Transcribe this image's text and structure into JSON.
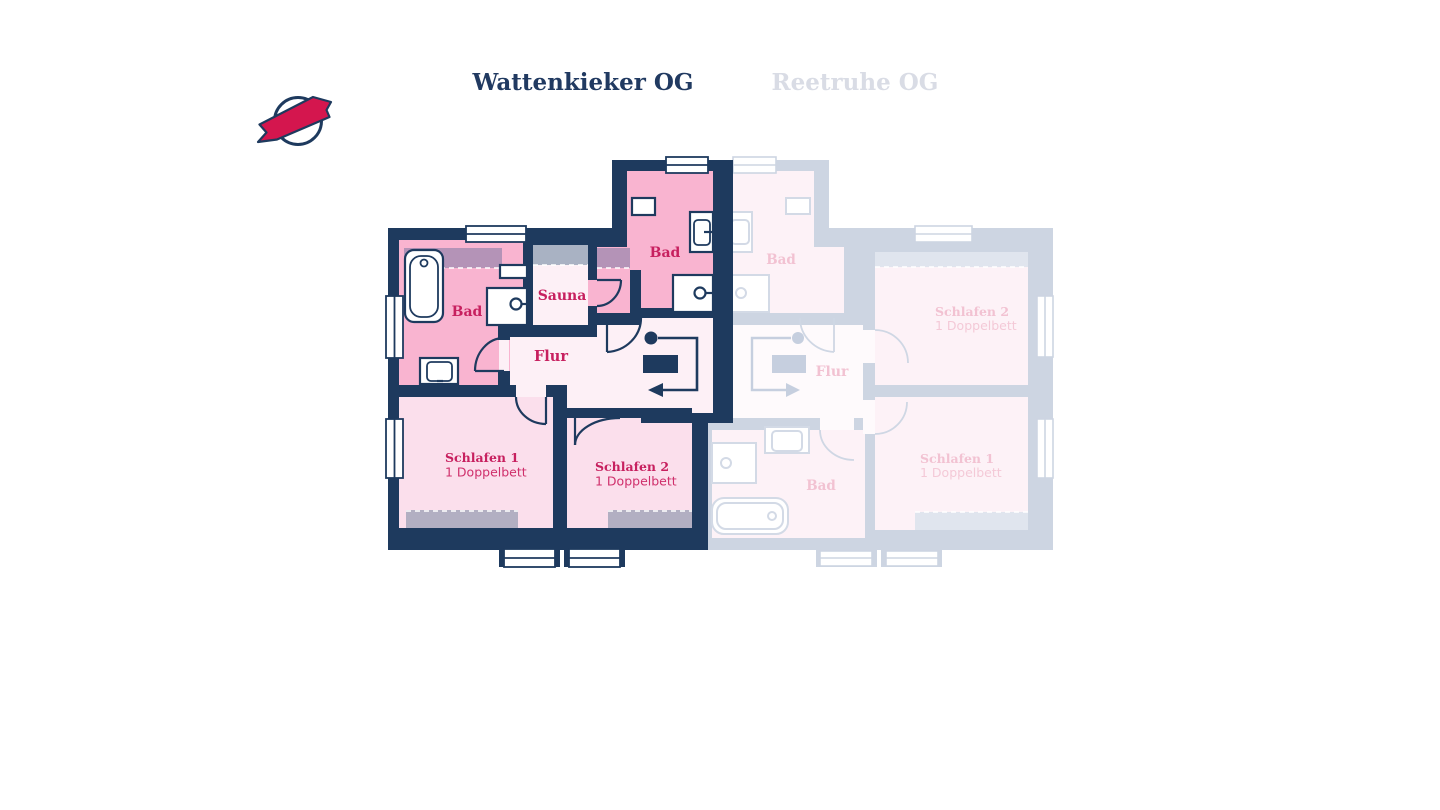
{
  "header": {
    "logo": {
      "name": "brand-logo",
      "ring_color": "#1e3a5e",
      "ribbon_color": "#d4164e"
    },
    "tabs": [
      {
        "label": "Wattenkieker OG",
        "active": true,
        "color": "#213a61"
      },
      {
        "label": "Reetruhe OG",
        "active": false,
        "color": "#d9dce5"
      }
    ]
  },
  "plans": {
    "wattenkieker": {
      "name": "Wattenkieker OG",
      "state": "active",
      "rooms": {
        "bad_top": {
          "label": "Bad"
        },
        "bad_left": {
          "label": "Bad"
        },
        "sauna": {
          "label": "Sauna"
        },
        "flur": {
          "label": "Flur"
        },
        "schlafen1": {
          "label": "Schlafen 1",
          "detail": "1 Doppelbett"
        },
        "schlafen2": {
          "label": "Schlafen 2",
          "detail": "1 Doppelbett"
        }
      }
    },
    "reetruhe": {
      "name": "Reetruhe OG",
      "state": "inactive",
      "rooms": {
        "bad_top": {
          "label": "Bad"
        },
        "flur": {
          "label": "Flur"
        },
        "bad_bottom": {
          "label": "Bad"
        },
        "schlafen2": {
          "label": "Schlafen 2",
          "detail": "1 Doppelbett"
        },
        "schlafen1": {
          "label": "Schlafen 1",
          "detail": "1 Doppelbett"
        }
      }
    }
  },
  "colors": {
    "wall_navy": "#1e3a5e",
    "room_pink_strong": "#f9b4d0",
    "room_pink_light": "#fbdfec",
    "room_pink_pale": "#fdf0f6",
    "label_crimson": "#c7205f",
    "detail_pink": "#cf2f6b",
    "hatch_on_pink": "#b493b7",
    "hatch_on_pale": "#a9b2c3",
    "hatch_on_light": "#b2afc2",
    "faded_wall": "#cdd5e2",
    "faded_room": "#fdf2f7",
    "faded_pale": "#fefafc",
    "faded_label": "#f2c2d2",
    "faded_stroke": "#d3dae6",
    "faded_hatch": "#e0e5ee"
  }
}
